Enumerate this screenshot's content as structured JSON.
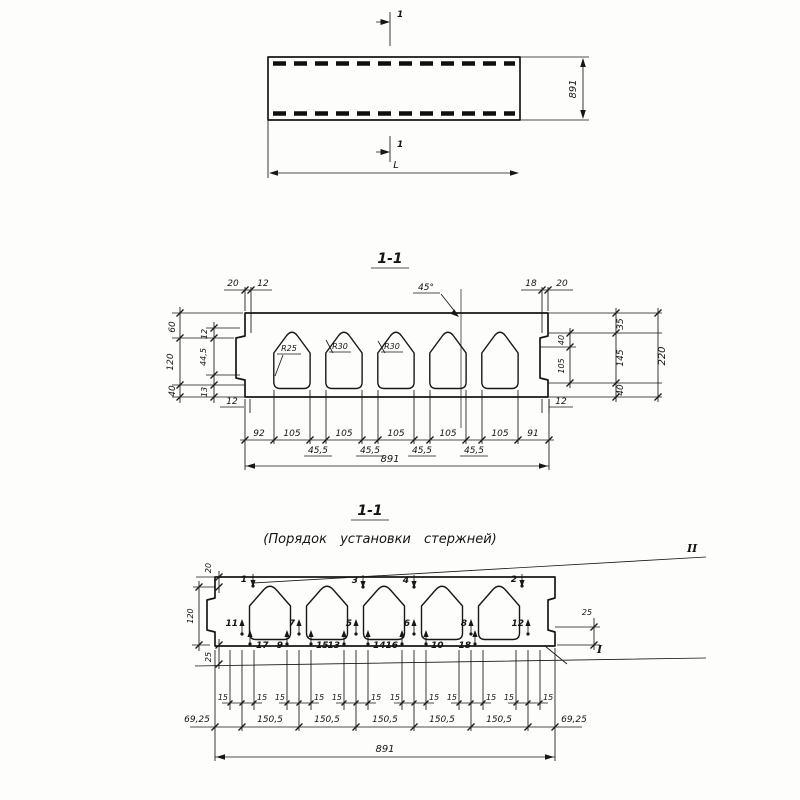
{
  "plan": {
    "section_mark_top": "1",
    "section_mark_bottom": "1",
    "length_label": "L",
    "width_label": "891"
  },
  "section": {
    "title": "1-1",
    "angle": "45°",
    "radii": [
      "R25",
      "R30",
      "R30"
    ],
    "top_left": [
      "20",
      "12"
    ],
    "top_right": [
      "18",
      "20"
    ],
    "left_outer": [
      "60",
      "120",
      "40"
    ],
    "left_inner": [
      "12",
      "44,5",
      "13"
    ],
    "right_inner": [
      "40",
      "105"
    ],
    "right_mid": [
      "35",
      "145",
      "40"
    ],
    "right_total": "220",
    "bottom_left_wall": "12",
    "bottom_right_wall": "12",
    "widths": [
      "92",
      "105",
      "105",
      "105",
      "105",
      "105",
      "91"
    ],
    "webs": [
      "45,5",
      "45,5",
      "45,5",
      "45,5"
    ],
    "total": "891"
  },
  "bars": {
    "title": "1-1",
    "subtitle": "(Порядок установки стержней)",
    "level_top": "II",
    "level_bottom": "I",
    "left": [
      "20",
      "120",
      "25"
    ],
    "right": "25",
    "top_bars": [
      "1",
      "3",
      "4",
      "2"
    ],
    "mid_bars": [
      "11",
      "7",
      "5",
      "6",
      "8",
      "12"
    ],
    "bottom_bars": [
      "17",
      "9",
      "15",
      "13",
      "14",
      "16",
      "10",
      "18"
    ],
    "spacings": [
      "15",
      "15",
      "15",
      "15",
      "15",
      "15",
      "15",
      "15",
      "15",
      "15",
      "15",
      "15"
    ],
    "bottom_dims": [
      "69,25",
      "150,5",
      "150,5",
      "150,5",
      "150,5",
      "150,5",
      "69,25"
    ],
    "total": "891"
  }
}
